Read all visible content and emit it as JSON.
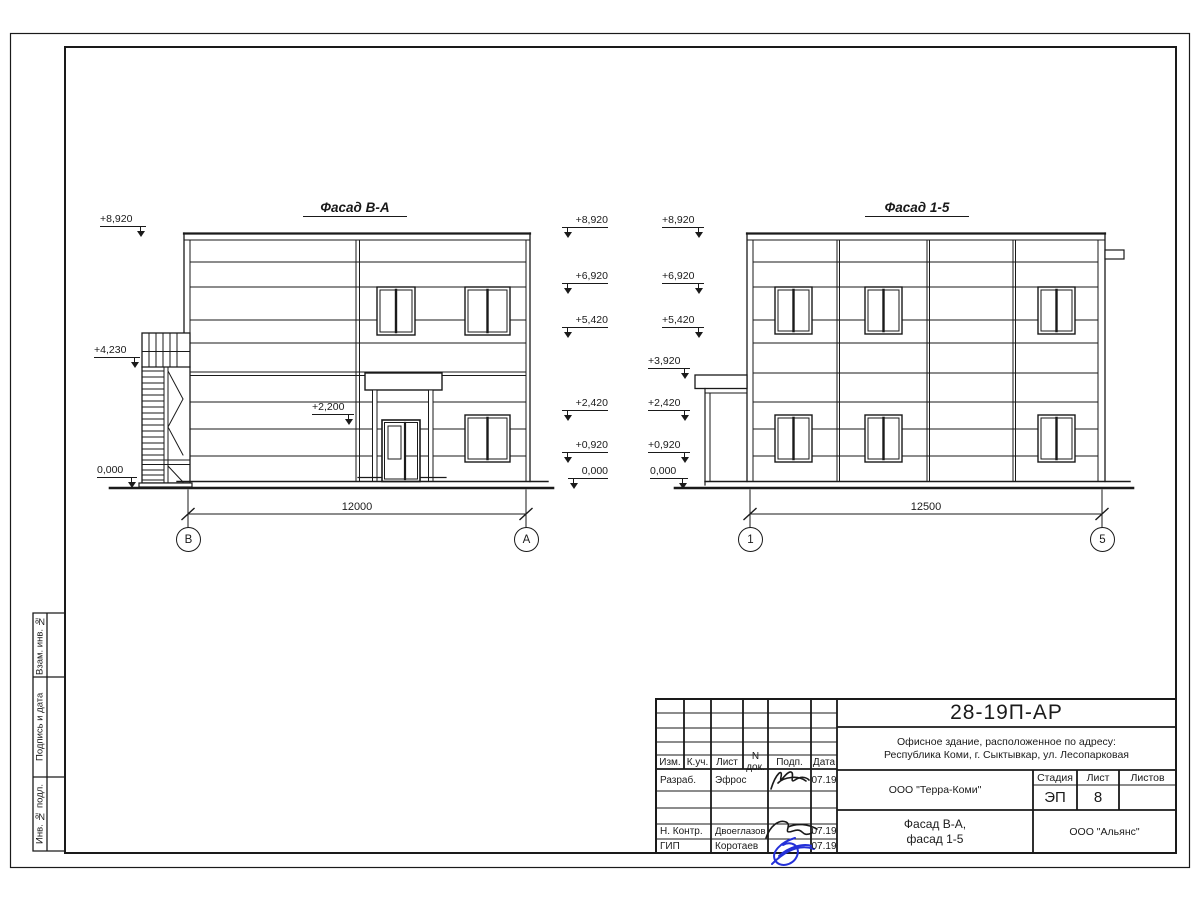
{
  "colors": {
    "ink": "#1a1a1a",
    "signature_blue": "#2430d8"
  },
  "facade_left": {
    "title": "Фасад В-А",
    "marks_left": [
      "+8,920",
      "+4,230",
      "0,000"
    ],
    "mark_entrance": "+2,200",
    "marks_right": [
      "+8,920",
      "+6,920",
      "+5,420",
      "+2,420",
      "+0,920",
      "0,000"
    ],
    "dimension": "12000",
    "axis_start": "В",
    "axis_end": "А"
  },
  "facade_right": {
    "title": "Фасад 1-5",
    "marks_left": [
      "+8,920",
      "+6,920",
      "+5,420",
      "+3,920",
      "+2,420",
      "+0,920",
      "0,000"
    ],
    "dimension": "12500",
    "axis_start": "1",
    "axis_end": "5"
  },
  "title_block": {
    "document_code": "28-19П-АР",
    "project_line1": "Офисное здание, расположенное по адресу:",
    "project_line2": "Республика Коми, г. Сыктывкар, ул. Лесопарковая",
    "design_org": "ООО \"Терра-Коми\"",
    "stage_label": "Стадия",
    "stage": "ЭП",
    "sheet_label": "Лист",
    "sheet": "8",
    "sheets_label": "Листов",
    "sheets": "",
    "drawing_line1": "Фасад В-А,",
    "drawing_line2": "фасад 1-5",
    "contractor_org": "ООО \"Альянс\"",
    "columns": [
      "Изм.",
      "К.уч.",
      "Лист",
      "N док.",
      "Подп.",
      "Дата"
    ],
    "rows": [
      {
        "role": "Разраб.",
        "name": "Эфрос",
        "date": "07.19"
      },
      {
        "role": "Н. Контр.",
        "name": "Двоеглазов",
        "date": "07.19"
      },
      {
        "role": "ГИП",
        "name": "Коротаев",
        "date": "07.19"
      }
    ]
  },
  "side_stamp": [
    "Взам. инв. №",
    "Подпись и дата",
    "Инв. № подл."
  ]
}
